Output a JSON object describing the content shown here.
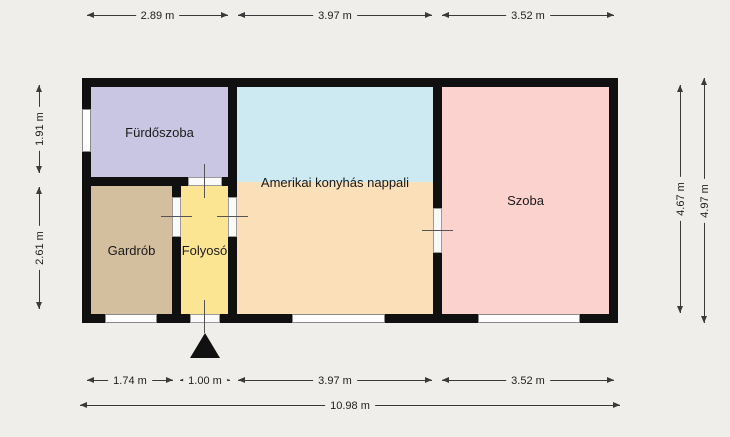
{
  "plan": {
    "rooms": [
      {
        "label": "Fürdőszoba",
        "color": "#c8c6e3"
      },
      {
        "label": "Gardrób",
        "color": "#d3bf9e"
      },
      {
        "label": "Folyosó",
        "color": "#fce592"
      },
      {
        "label": "Amerikai konyhás nappali",
        "color_top": "#cdeaf2",
        "color_bottom": "#fbdfb9"
      },
      {
        "label": "Szoba",
        "color": "#fcd2ce"
      }
    ],
    "dimensions": {
      "top": [
        "2.89 m",
        "3.97 m",
        "3.52 m"
      ],
      "bottom": [
        "1.74 m",
        "1.00 m",
        "3.97 m",
        "3.52 m"
      ],
      "total_width": "10.98 m",
      "left": [
        "1.91 m",
        "2.61 m"
      ],
      "right": [
        "4.67 m",
        "4.97 m"
      ]
    },
    "colors": {
      "background": "#f0eeea",
      "wall": "#101010",
      "window": "#ffffff",
      "dimension_line": "#3a3a3a"
    }
  }
}
